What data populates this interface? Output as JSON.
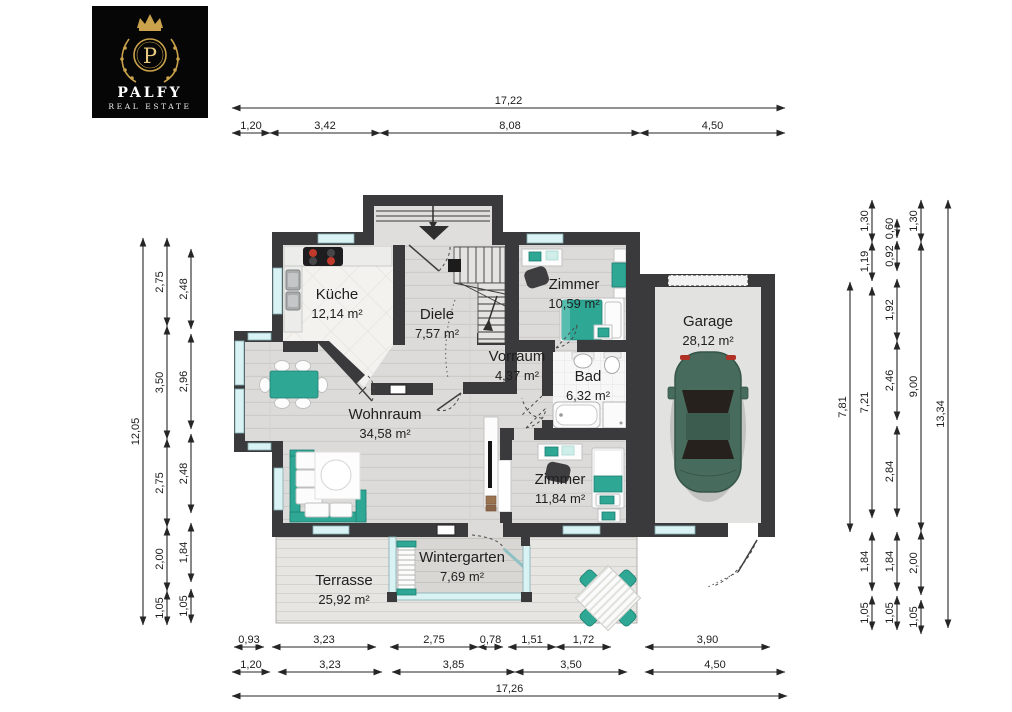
{
  "logo": {
    "brand": "PALFY",
    "tagline": "REAL ESTATE",
    "monogram": "P"
  },
  "colors": {
    "wall": "#3a3a3c",
    "accent": "#2ea795",
    "accent_dark": "#1d7f72",
    "window": "#d9f2f4",
    "car": "#476b5d",
    "dim": "#262626",
    "logo_gold": "#c9a24b"
  },
  "rooms": [
    {
      "id": "kueche",
      "name": "Küche",
      "area": "12,14 m²",
      "cx": 337,
      "cy": 299
    },
    {
      "id": "diele",
      "name": "Diele",
      "area": "7,57 m²",
      "cx": 437,
      "cy": 319
    },
    {
      "id": "zimmer-1",
      "name": "Zimmer",
      "area": "10,59 m²",
      "cx": 574,
      "cy": 289
    },
    {
      "id": "vorraum",
      "name": "Vorraum",
      "area": "4,37 m²",
      "cx": 517,
      "cy": 361
    },
    {
      "id": "bad",
      "name": "Bad",
      "area": "6,32 m²",
      "cx": 588,
      "cy": 381
    },
    {
      "id": "wohnraum",
      "name": "Wohnraum",
      "area": "34,58 m²",
      "cx": 385,
      "cy": 419
    },
    {
      "id": "zimmer-2",
      "name": "Zimmer",
      "area": "11,84 m²",
      "cx": 560,
      "cy": 484
    },
    {
      "id": "garage",
      "name": "Garage",
      "area": "28,12 m²",
      "cx": 708,
      "cy": 326
    },
    {
      "id": "wintergarten",
      "name": "Wintergarten",
      "area": "7,69 m²",
      "cx": 462,
      "cy": 562
    },
    {
      "id": "terrasse",
      "name": "Terrasse",
      "area": "25,92 m²",
      "cx": 344,
      "cy": 585
    }
  ],
  "dimensions": {
    "top": [
      {
        "pos": 108,
        "segs": [
          {
            "f": 232,
            "t": 785,
            "l": "17,22"
          }
        ]
      },
      {
        "pos": 133,
        "segs": [
          {
            "f": 232,
            "t": 270,
            "l": "1,20"
          },
          {
            "f": 270,
            "t": 380,
            "l": "3,42"
          },
          {
            "f": 380,
            "t": 640,
            "l": "8,08"
          },
          {
            "f": 640,
            "t": 785,
            "l": "4,50"
          }
        ]
      }
    ],
    "bottom": [
      {
        "pos": 647,
        "segs": [
          {
            "f": 234,
            "t": 264,
            "l": "0,93"
          },
          {
            "f": 272,
            "t": 376,
            "l": "3,23"
          },
          {
            "f": 390,
            "t": 478,
            "l": "2,75"
          },
          {
            "f": 478,
            "t": 503,
            "l": "0,78"
          },
          {
            "f": 508,
            "t": 556,
            "l": "1,51"
          },
          {
            "f": 556,
            "t": 611,
            "l": "1,72"
          },
          {
            "f": 645,
            "t": 770,
            "l": "3,90"
          }
        ]
      },
      {
        "pos": 672,
        "segs": [
          {
            "f": 232,
            "t": 270,
            "l": "1,20"
          },
          {
            "f": 278,
            "t": 382,
            "l": "3,23"
          },
          {
            "f": 392,
            "t": 515,
            "l": "3,85"
          },
          {
            "f": 515,
            "t": 627,
            "l": "3,50"
          },
          {
            "f": 645,
            "t": 785,
            "l": "4,50"
          }
        ]
      },
      {
        "pos": 696,
        "segs": [
          {
            "f": 232,
            "t": 787,
            "l": "17,26"
          }
        ]
      }
    ],
    "left": [
      {
        "pos": 143,
        "segs": [
          {
            "f": 238,
            "t": 625,
            "l": "12,05"
          }
        ]
      },
      {
        "pos": 167,
        "segs": [
          {
            "f": 238,
            "t": 326,
            "l": "2,75"
          },
          {
            "f": 326,
            "t": 439,
            "l": "3,50"
          },
          {
            "f": 439,
            "t": 527,
            "l": "2,75"
          },
          {
            "f": 527,
            "t": 591,
            "l": "2,00"
          },
          {
            "f": 591,
            "t": 625,
            "l": "1,05"
          }
        ]
      },
      {
        "pos": 191,
        "segs": [
          {
            "f": 249,
            "t": 329,
            "l": "2,48"
          },
          {
            "f": 334,
            "t": 429,
            "l": "2,96"
          },
          {
            "f": 434,
            "t": 513,
            "l": "2,48"
          },
          {
            "f": 523,
            "t": 582,
            "l": "1,84"
          },
          {
            "f": 589,
            "t": 623,
            "l": "1,05"
          }
        ]
      }
    ],
    "right": [
      {
        "pos": 850,
        "segs": [
          {
            "f": 282,
            "t": 532,
            "l": "7,81"
          }
        ]
      },
      {
        "pos": 872,
        "segs": [
          {
            "f": 200,
            "t": 242,
            "l": "1,30"
          },
          {
            "f": 242,
            "t": 281,
            "l": "1,19"
          },
          {
            "f": 287,
            "t": 518,
            "l": "7,21"
          },
          {
            "f": 532,
            "t": 591,
            "l": "1,84"
          },
          {
            "f": 596,
            "t": 630,
            "l": "1,05"
          }
        ]
      },
      {
        "pos": 897,
        "segs": [
          {
            "f": 219,
            "t": 238,
            "l": "0,60"
          },
          {
            "f": 241,
            "t": 271,
            "l": "0,92"
          },
          {
            "f": 279,
            "t": 341,
            "l": "1,92"
          },
          {
            "f": 341,
            "t": 420,
            "l": "2,46"
          },
          {
            "f": 426,
            "t": 517,
            "l": "2,84"
          },
          {
            "f": 532,
            "t": 591,
            "l": "1,84"
          },
          {
            "f": 596,
            "t": 630,
            "l": "1,05"
          }
        ]
      },
      {
        "pos": 921,
        "segs": [
          {
            "f": 200,
            "t": 242,
            "l": "1,30"
          },
          {
            "f": 242,
            "t": 531,
            "l": "9,00"
          },
          {
            "f": 531,
            "t": 595,
            "l": "2,00"
          },
          {
            "f": 600,
            "t": 634,
            "l": "1,05"
          }
        ]
      },
      {
        "pos": 948,
        "segs": [
          {
            "f": 200,
            "t": 628,
            "l": "13,34"
          }
        ]
      }
    ]
  }
}
